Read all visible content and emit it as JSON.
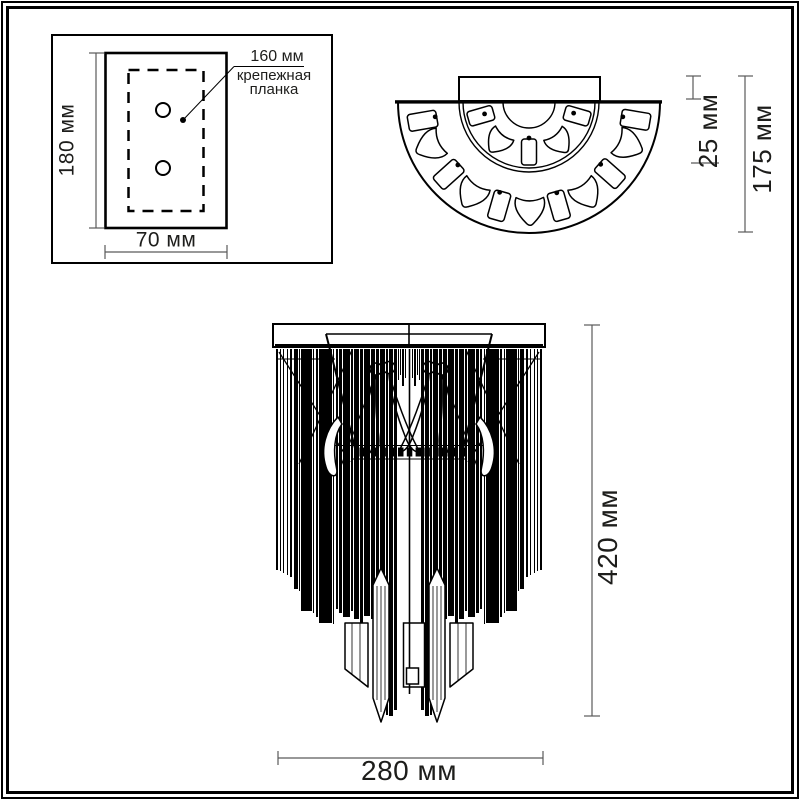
{
  "drawing": {
    "mount_plate_view": {
      "height_label": "180 мм",
      "width_label": "70 мм",
      "bar_length_label": "160 мм",
      "bar_name_label": "крепежная планка"
    },
    "top_view": {
      "canopy_depth_label": "25 мм",
      "total_depth_label": "175 мм"
    },
    "front_view": {
      "height_label": "420 мм",
      "width_label": "280 мм"
    }
  },
  "colors": {
    "line": "#000000",
    "dimension_line": "#5a5a5a",
    "text": "#1d1d1b",
    "background": "#ffffff"
  }
}
